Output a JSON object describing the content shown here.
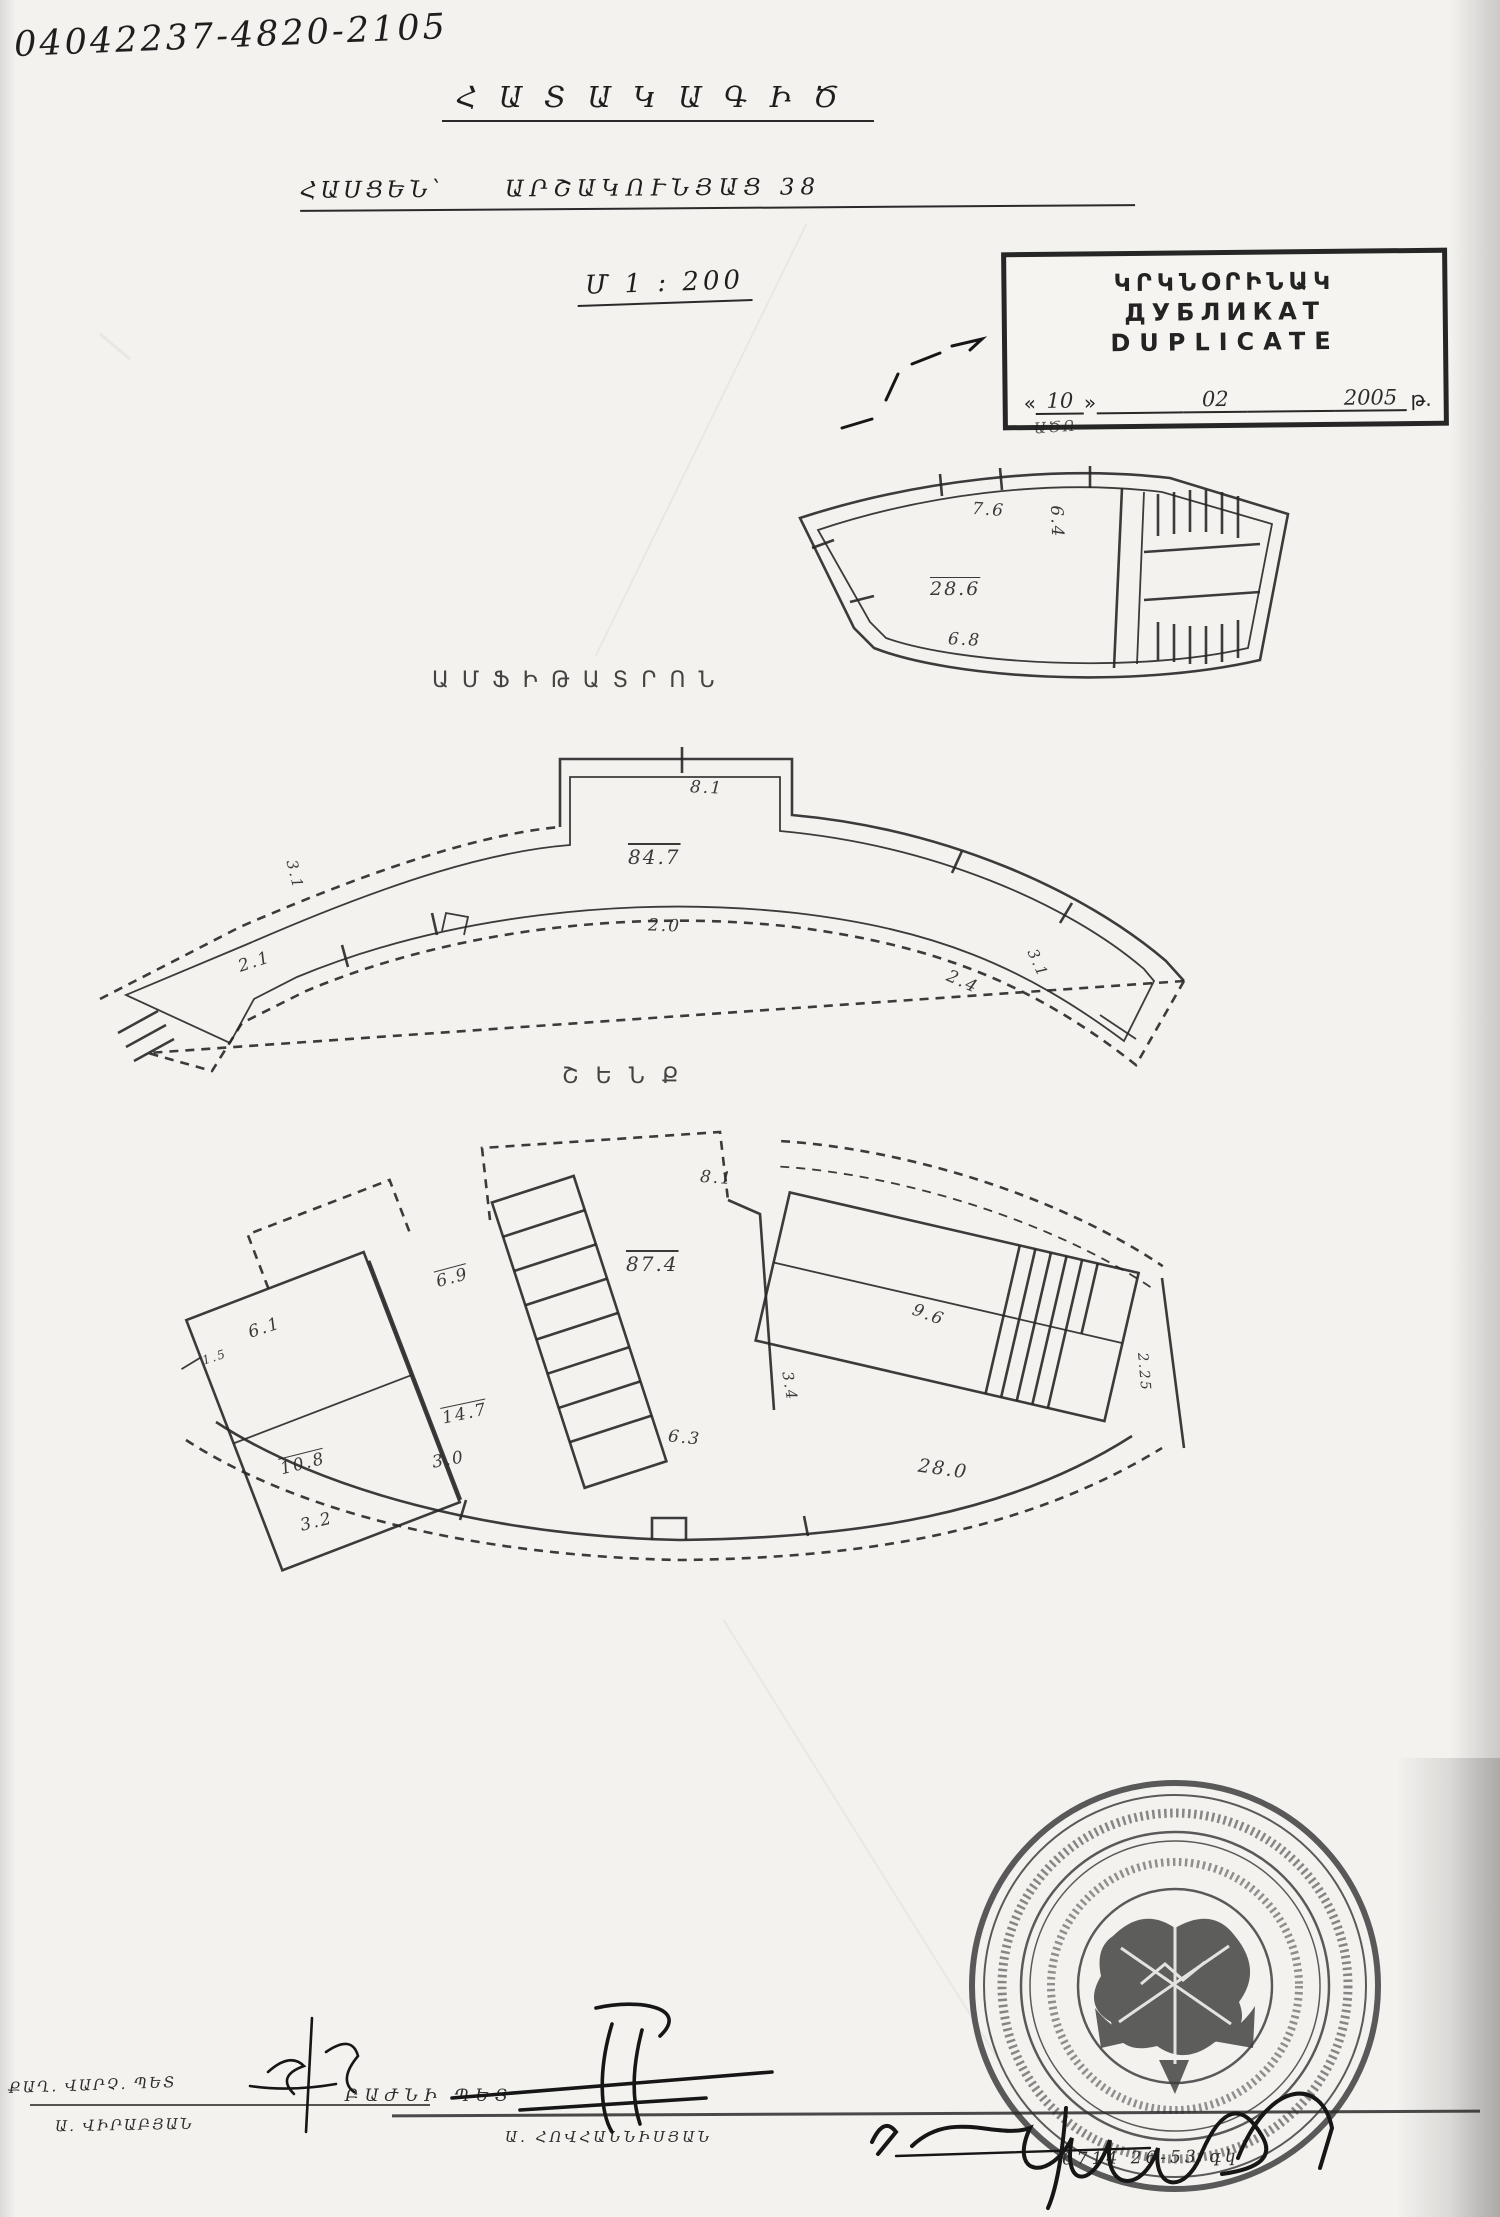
{
  "header": {
    "ref_number": "04042237-4820-2105",
    "title": "ՀԱՏԱԿԱԳԻԾ",
    "address_label": "ՀԱՍՑԵՆ՝",
    "address_value": "ԱՐՇԱԿՈՒՆՅԱՑ 38",
    "scale": "Մ 1 ։ 200"
  },
  "stamp": {
    "armenian": "ԿՐԿՆՕՐԻՆԱԿ",
    "russian": "ДУБЛИКАТ",
    "english": "DUPLICATE",
    "quote_open": "«",
    "quote_close": "»",
    "day": "10",
    "month": "02",
    "year": "2005",
    "year_suffix": "թ.",
    "note": "ԱԾՈ"
  },
  "plans": {
    "amphitheater_caption": "ԱՄՖԻԹԱՏՐՈՆ",
    "ground_caption": "ՇԵՆՔ"
  },
  "dims": {
    "p1": [
      "7.6",
      "28.6",
      "6.8",
      "6.4"
    ],
    "p2": [
      "8.1",
      "84.7",
      "2.0",
      "3.1",
      "2.1",
      "2.4",
      "3.1"
    ],
    "p3": [
      "8.1",
      "6.9",
      "87.4",
      "9.6",
      "6.1",
      "1.5",
      "14.7",
      "10.8",
      "3.2",
      "3.0",
      "6.3",
      "3.4",
      "28.0",
      "2.25"
    ]
  },
  "footer": {
    "left_title": "ՔԱՂ. ՎԱՐՉ. ՊԵՏ",
    "left_name": "Ա. ՎԻՐԱԲՅԱՆ",
    "center_title": "ԲԱԺՆԻ ՊԵՏ",
    "center_name": "Ա. ՀՈՎՀԱՆՆԻՍՅԱՆ",
    "right_note": "6714 26-53 գկ"
  },
  "colors": {
    "ink": "#1e1e1e",
    "plan_line": "#272727",
    "seal": "#3f3f3f",
    "paper": "#f3f2ef"
  }
}
